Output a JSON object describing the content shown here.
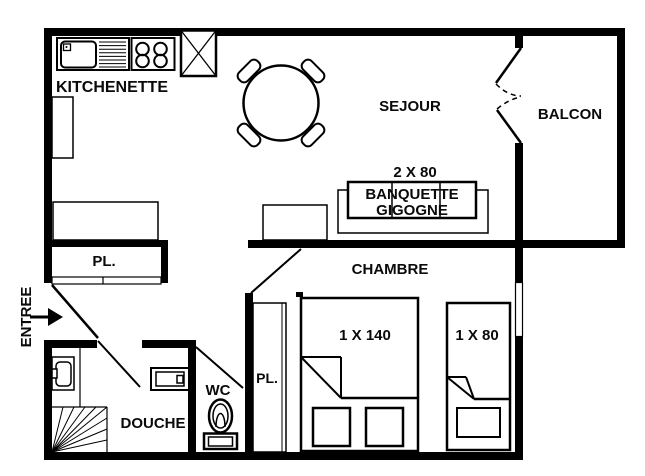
{
  "colors": {
    "wall": "#000000",
    "background": "#ffffff",
    "text": "#0a0a0a"
  },
  "rooms": {
    "kitchenette": {
      "label": "KITCHENETTE"
    },
    "sejour": {
      "label": "SEJOUR"
    },
    "balcon": {
      "label": "BALCON"
    },
    "chambre": {
      "label": "CHAMBRE"
    },
    "douche": {
      "label": "DOUCHE"
    },
    "wc": {
      "label": "WC"
    },
    "entree": {
      "label": "ENTREE"
    },
    "closet_hall": {
      "label": "PL."
    },
    "closet_chambre": {
      "label": "PL."
    }
  },
  "furniture": {
    "banquette": {
      "dimension": "2 X 80",
      "name_line1": "BANQUETTE",
      "name_line2": "GIGOGNE"
    },
    "bed_large": {
      "dimension": "1 X 140"
    },
    "bed_small": {
      "dimension": "1 X 80"
    }
  },
  "icons": [
    "sink-icon",
    "stove-icon",
    "vent-shaft-icon",
    "fridge-icon",
    "dining-table-icon",
    "chair-icon",
    "washbasin-icon",
    "shower-tray-icon",
    "toilet-icon",
    "stairs-icon",
    "entree-arrow-icon",
    "door-swing-icon",
    "window-icon"
  ]
}
